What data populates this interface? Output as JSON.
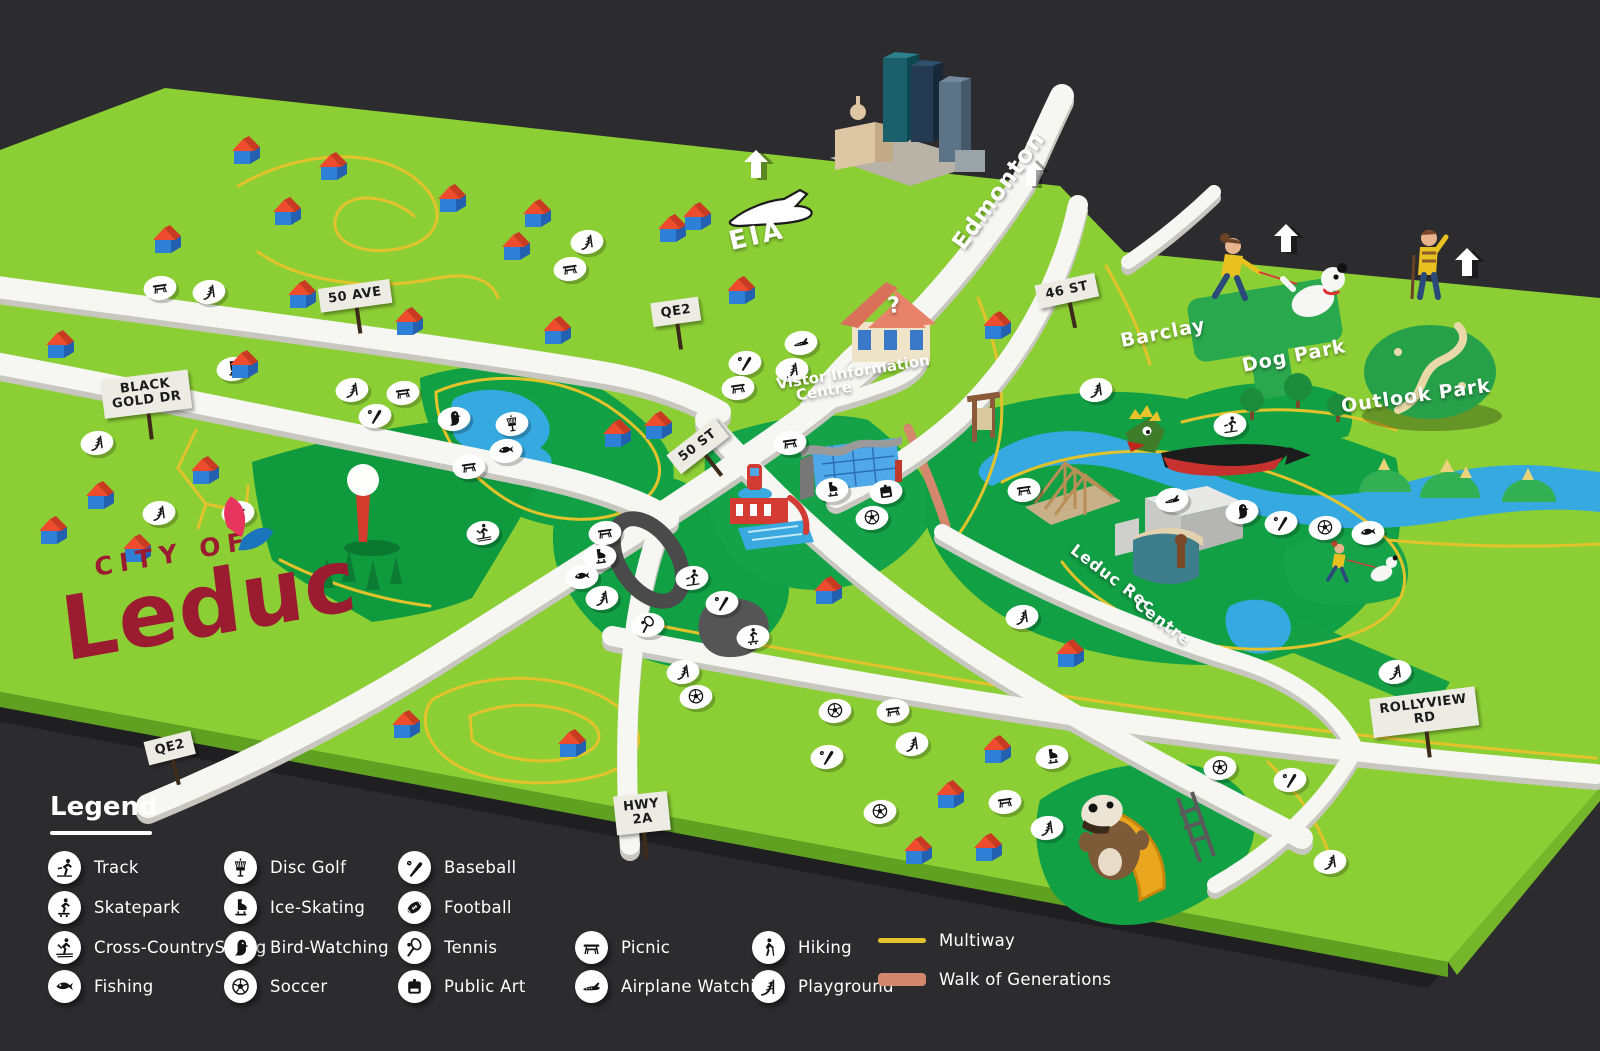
{
  "background_color": "#2c2c2e",
  "logo": {
    "line1": "CITY OF",
    "line2": "Leduc",
    "color": "#9b1c31"
  },
  "colors": {
    "plane_green": "#8ccf35",
    "park_dark_green": "#12a045",
    "water_blue": "#36a9e1",
    "road_white": "#f6f6f3",
    "multiway_yellow": "#e2c32c",
    "walk_of_generations_salmon": "#d3886d",
    "sign_plate": "#ecece4",
    "logo_red": "#9b1c31"
  },
  "map_labels": [
    {
      "text": "EIA",
      "x": 757,
      "y": 236,
      "rot": -13,
      "size": 26,
      "ls": 3
    },
    {
      "text": "Edmonton",
      "x": 999,
      "y": 191,
      "rot": -54,
      "size": 23,
      "ls": 1
    },
    {
      "text": "Vistor Information",
      "x": 853,
      "y": 372,
      "rot": -9,
      "size": 15,
      "ls": 0
    },
    {
      "text": "Centre",
      "x": 824,
      "y": 391,
      "rot": -9,
      "size": 15,
      "ls": 0
    },
    {
      "text": "Barclay",
      "x": 1163,
      "y": 333,
      "rot": -11,
      "size": 19,
      "ls": 1
    },
    {
      "text": "Dog Park",
      "x": 1294,
      "y": 356,
      "rot": -11,
      "size": 19,
      "ls": 1
    },
    {
      "text": "Outlook Park",
      "x": 1416,
      "y": 396,
      "rot": -8,
      "size": 19,
      "ls": 1
    },
    {
      "text": "Leduc Rec",
      "x": 1113,
      "y": 578,
      "rot": 37,
      "size": 16,
      "ls": 1
    },
    {
      "text": "Centre",
      "x": 1163,
      "y": 622,
      "rot": 37,
      "size": 16,
      "ls": 1
    },
    {
      "text": "?",
      "x": 894,
      "y": 306,
      "rot": -6,
      "size": 22,
      "ls": 0
    }
  ],
  "road_signs": [
    {
      "text": "50 AVE",
      "x": 355,
      "y": 296,
      "rot": -8
    },
    {
      "text": "BLACK\nGOLD DR",
      "x": 146,
      "y": 394,
      "rot": -7
    },
    {
      "text": "QE2",
      "x": 676,
      "y": 312,
      "rot": -8
    },
    {
      "text": "QE2",
      "x": 170,
      "y": 748,
      "rot": -14
    },
    {
      "text": "50 ST",
      "x": 698,
      "y": 446,
      "rot": -38
    },
    {
      "text": "46 ST",
      "x": 1067,
      "y": 291,
      "rot": -12
    },
    {
      "text": "HWY\n2A",
      "x": 642,
      "y": 813,
      "rot": -6
    },
    {
      "text": "ROLLYVIEW\nRD",
      "x": 1424,
      "y": 712,
      "rot": -7
    }
  ],
  "legend": {
    "title": "Legend",
    "col_x": [
      48,
      224,
      398,
      575,
      752,
      878
    ],
    "row_y": [
      851,
      891,
      931,
      970
    ],
    "items": [
      {
        "icon": "track",
        "label": "Track",
        "col": 0,
        "row": 0
      },
      {
        "icon": "skatepark",
        "label": "Skatepark",
        "col": 0,
        "row": 1
      },
      {
        "icon": "xcski",
        "label": "Cross-CountrySkiing",
        "col": 0,
        "row": 2
      },
      {
        "icon": "fishing",
        "label": "Fishing",
        "col": 0,
        "row": 3
      },
      {
        "icon": "discgolf",
        "label": "Disc Golf",
        "col": 1,
        "row": 0
      },
      {
        "icon": "ice",
        "label": "Ice-Skating",
        "col": 1,
        "row": 1
      },
      {
        "icon": "bird",
        "label": "Bird-Watching",
        "col": 1,
        "row": 2
      },
      {
        "icon": "soccer",
        "label": "Soccer",
        "col": 1,
        "row": 3
      },
      {
        "icon": "baseball",
        "label": "Baseball",
        "col": 2,
        "row": 0
      },
      {
        "icon": "football",
        "label": "Football",
        "col": 2,
        "row": 1
      },
      {
        "icon": "tennis",
        "label": "Tennis",
        "col": 2,
        "row": 2
      },
      {
        "icon": "publicart",
        "label": "Public Art",
        "col": 2,
        "row": 3
      },
      {
        "icon": "picnic",
        "label": "Picnic",
        "col": 3,
        "row": 2
      },
      {
        "icon": "airplane",
        "label": "Airplane Watching",
        "col": 3,
        "row": 3
      },
      {
        "icon": "hiking",
        "label": "Hiking",
        "col": 4,
        "row": 2
      },
      {
        "icon": "playground",
        "label": "Playground",
        "col": 4,
        "row": 3
      }
    ],
    "swatches": [
      {
        "label": "Multiway",
        "kind": "line",
        "color": "#e2c32c",
        "col": 5,
        "row": 2
      },
      {
        "label": "Walk of Generations",
        "kind": "bar",
        "color": "#d3886d",
        "col": 5,
        "row": 3
      }
    ]
  },
  "arrows": [
    [
      757,
      164
    ],
    [
      1032,
      172
    ],
    [
      1287,
      238
    ],
    [
      1468,
      262
    ]
  ],
  "houses": [
    [
      246,
      152
    ],
    [
      333,
      168
    ],
    [
      287,
      213
    ],
    [
      167,
      241
    ],
    [
      60,
      346
    ],
    [
      302,
      296
    ],
    [
      409,
      323
    ],
    [
      452,
      200
    ],
    [
      537,
      215
    ],
    [
      516,
      248
    ],
    [
      672,
      230
    ],
    [
      697,
      218
    ],
    [
      557,
      332
    ],
    [
      244,
      366
    ],
    [
      205,
      472
    ],
    [
      100,
      497
    ],
    [
      53,
      532
    ],
    [
      137,
      550
    ],
    [
      741,
      292
    ],
    [
      997,
      327
    ],
    [
      658,
      427
    ],
    [
      617,
      435
    ],
    [
      828,
      592
    ],
    [
      1070,
      655
    ],
    [
      997,
      751
    ],
    [
      950,
      796
    ],
    [
      918,
      852
    ],
    [
      988,
      849
    ],
    [
      406,
      726
    ],
    [
      572,
      745
    ]
  ],
  "badges": [
    [
      "picnic",
      160,
      288
    ],
    [
      "playground",
      209,
      292
    ],
    [
      "ice",
      233,
      369
    ],
    [
      "playground",
      352,
      390
    ],
    [
      "picnic",
      403,
      393
    ],
    [
      "baseball",
      375,
      416
    ],
    [
      "bird",
      454,
      419
    ],
    [
      "discgolf",
      512,
      424
    ],
    [
      "fishing",
      506,
      451
    ],
    [
      "picnic",
      469,
      467
    ],
    [
      "xcski",
      483,
      533
    ],
    [
      "playground",
      587,
      242
    ],
    [
      "picnic",
      570,
      269
    ],
    [
      "playground",
      97,
      443
    ],
    [
      "playground",
      159,
      513
    ],
    [
      "picnic",
      238,
      513
    ],
    [
      "airplane",
      801,
      343
    ],
    [
      "baseball",
      745,
      363
    ],
    [
      "playground",
      792,
      370
    ],
    [
      "picnic",
      738,
      388
    ],
    [
      "picnic",
      790,
      443
    ],
    [
      "ice",
      832,
      490
    ],
    [
      "publicart",
      886,
      492
    ],
    [
      "soccer",
      872,
      518
    ],
    [
      "playground",
      1096,
      390
    ],
    [
      "track",
      1230,
      425
    ],
    [
      "picnic",
      1024,
      490
    ],
    [
      "airplane",
      1172,
      500
    ],
    [
      "bird",
      1242,
      512
    ],
    [
      "baseball",
      1281,
      523
    ],
    [
      "soccer",
      1325,
      528
    ],
    [
      "fishing",
      1368,
      533
    ],
    [
      "playground",
      1022,
      617
    ],
    [
      "picnic",
      605,
      533
    ],
    [
      "ice",
      600,
      557
    ],
    [
      "fishing",
      582,
      577
    ],
    [
      "playground",
      602,
      598
    ],
    [
      "tennis",
      648,
      625
    ],
    [
      "track",
      692,
      578
    ],
    [
      "baseball",
      722,
      603
    ],
    [
      "skatepark",
      753,
      637
    ],
    [
      "playground",
      683,
      672
    ],
    [
      "soccer",
      696,
      697
    ],
    [
      "soccer",
      835,
      711
    ],
    [
      "picnic",
      893,
      711
    ],
    [
      "baseball",
      827,
      757
    ],
    [
      "playground",
      912,
      744
    ],
    [
      "ice",
      1052,
      757
    ],
    [
      "picnic",
      1005,
      802
    ],
    [
      "playground",
      1047,
      828
    ],
    [
      "soccer",
      880,
      812
    ],
    [
      "soccer",
      1220,
      768
    ],
    [
      "baseball",
      1290,
      780
    ],
    [
      "playground",
      1395,
      672
    ],
    [
      "playground",
      1330,
      862
    ]
  ]
}
